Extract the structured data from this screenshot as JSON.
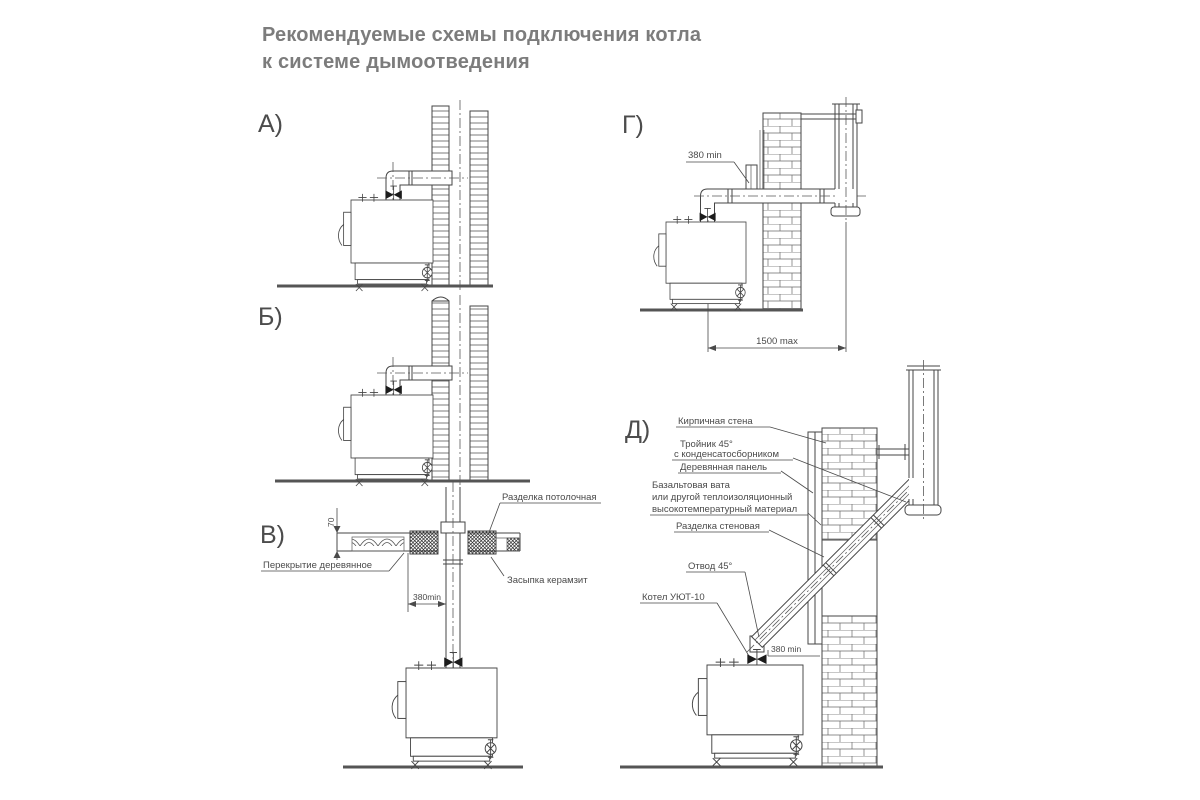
{
  "title": {
    "line1": "Рекомендуемые схемы подключения котла",
    "line2": "к системе дымоотведения"
  },
  "diagrams": {
    "a": {
      "letter": "А)"
    },
    "b": {
      "letter": "Б)"
    },
    "v": {
      "letter": "В)",
      "labels": {
        "ceiling_cut": "Разделка потолочная",
        "wood_floor": "Перекрытие деревянное",
        "backfill": "Засыпка керамзит",
        "dim_thickness": "70",
        "dim_min": "380min"
      }
    },
    "g": {
      "letter": "Г)",
      "labels": {
        "dim_min": "380 min",
        "dim_max": "1500 max"
      }
    },
    "d": {
      "letter": "Д)",
      "labels": {
        "brick_wall": "Кирпичная стена",
        "tee_line1": "Тройник 45°",
        "tee_line2": "с конденсатосборником",
        "wood_panel": "Деревянная панель",
        "insulation_line1": "Базальтовая вата",
        "insulation_line2": "или другой теплоизоляционный",
        "insulation_line3": "высокотемпературный материал",
        "wall_cut": "Разделка стеновая",
        "elbow": "Отвод 45°",
        "boiler": "Котел УЮТ-10",
        "dim_min": "380 min"
      }
    }
  },
  "colors": {
    "line": "#454545",
    "title_text": "#7c7c7c",
    "label_text": "#4a4a4a",
    "background": "#ffffff"
  }
}
